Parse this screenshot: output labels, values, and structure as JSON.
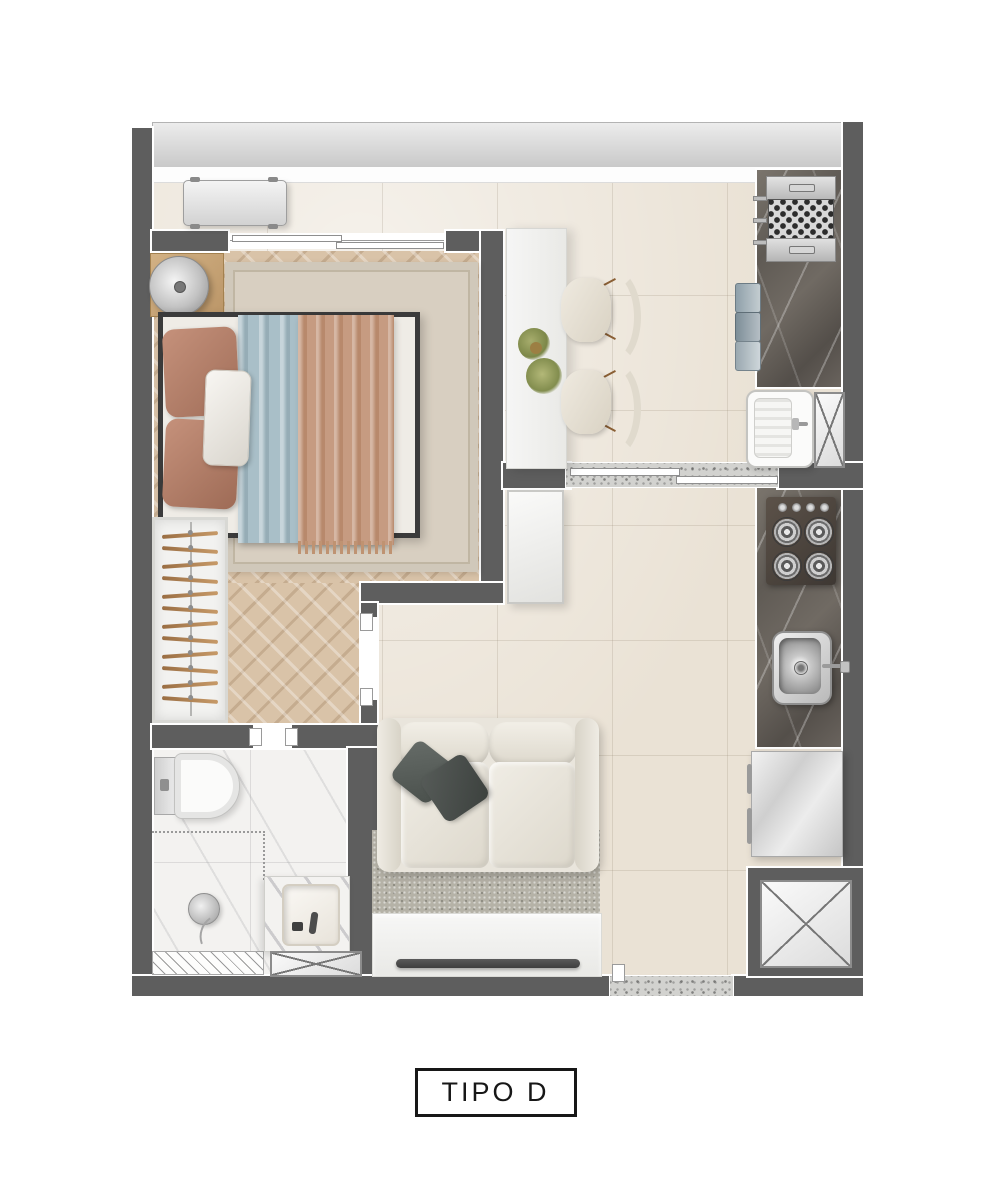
{
  "plan": {
    "label": "TIPO D",
    "type": "apartment-floor-plan",
    "items": [
      "balcony-glass-railing",
      "ac-unit",
      "bedroom-window",
      "nightstand",
      "table-lamp",
      "bed",
      "pillows",
      "duvet",
      "throw-blanket",
      "bedroom-rug",
      "wardrobe-hangers",
      "dining-table",
      "plant-centerpiece",
      "dining-chair-1",
      "dining-chair-2",
      "barbecue-grill",
      "gourmet-counter",
      "counter-tray-stack",
      "laundry-tank",
      "service-shaft-small",
      "sliding-door",
      "storage-cabinet",
      "cooktop",
      "kitchen-sink",
      "kitchen-counter",
      "fridge",
      "utility-shaft",
      "sofa",
      "sofa-pillows",
      "living-rug",
      "tv-console",
      "tv",
      "toilet",
      "shower-mixer",
      "shower-drain",
      "bathroom-vanity",
      "bathroom-basin",
      "bathroom-duct",
      "entry-threshold",
      "hall-door-opening",
      "bathroom-door-opening"
    ]
  },
  "colors": {
    "wall": "#5e5e5e",
    "floor_tile": "#eae2d5",
    "wood": "#d9c3a8",
    "marble_light": "#f3f2f0",
    "rug_bedroom": "#d8cfc1",
    "rug_living": "#b5b2a7",
    "sofa": "#e9e5dc",
    "duvet_blue": "#a9bfc8",
    "throw_terracotta": "#c69b81",
    "pillow_terracotta": "#b5826c",
    "glass": "#d9d9d9",
    "white_furniture": "#f3f3f1",
    "stainless": "#cfcfcf",
    "accent_dark": "#3c3c3c",
    "label_ink": "#171717"
  }
}
